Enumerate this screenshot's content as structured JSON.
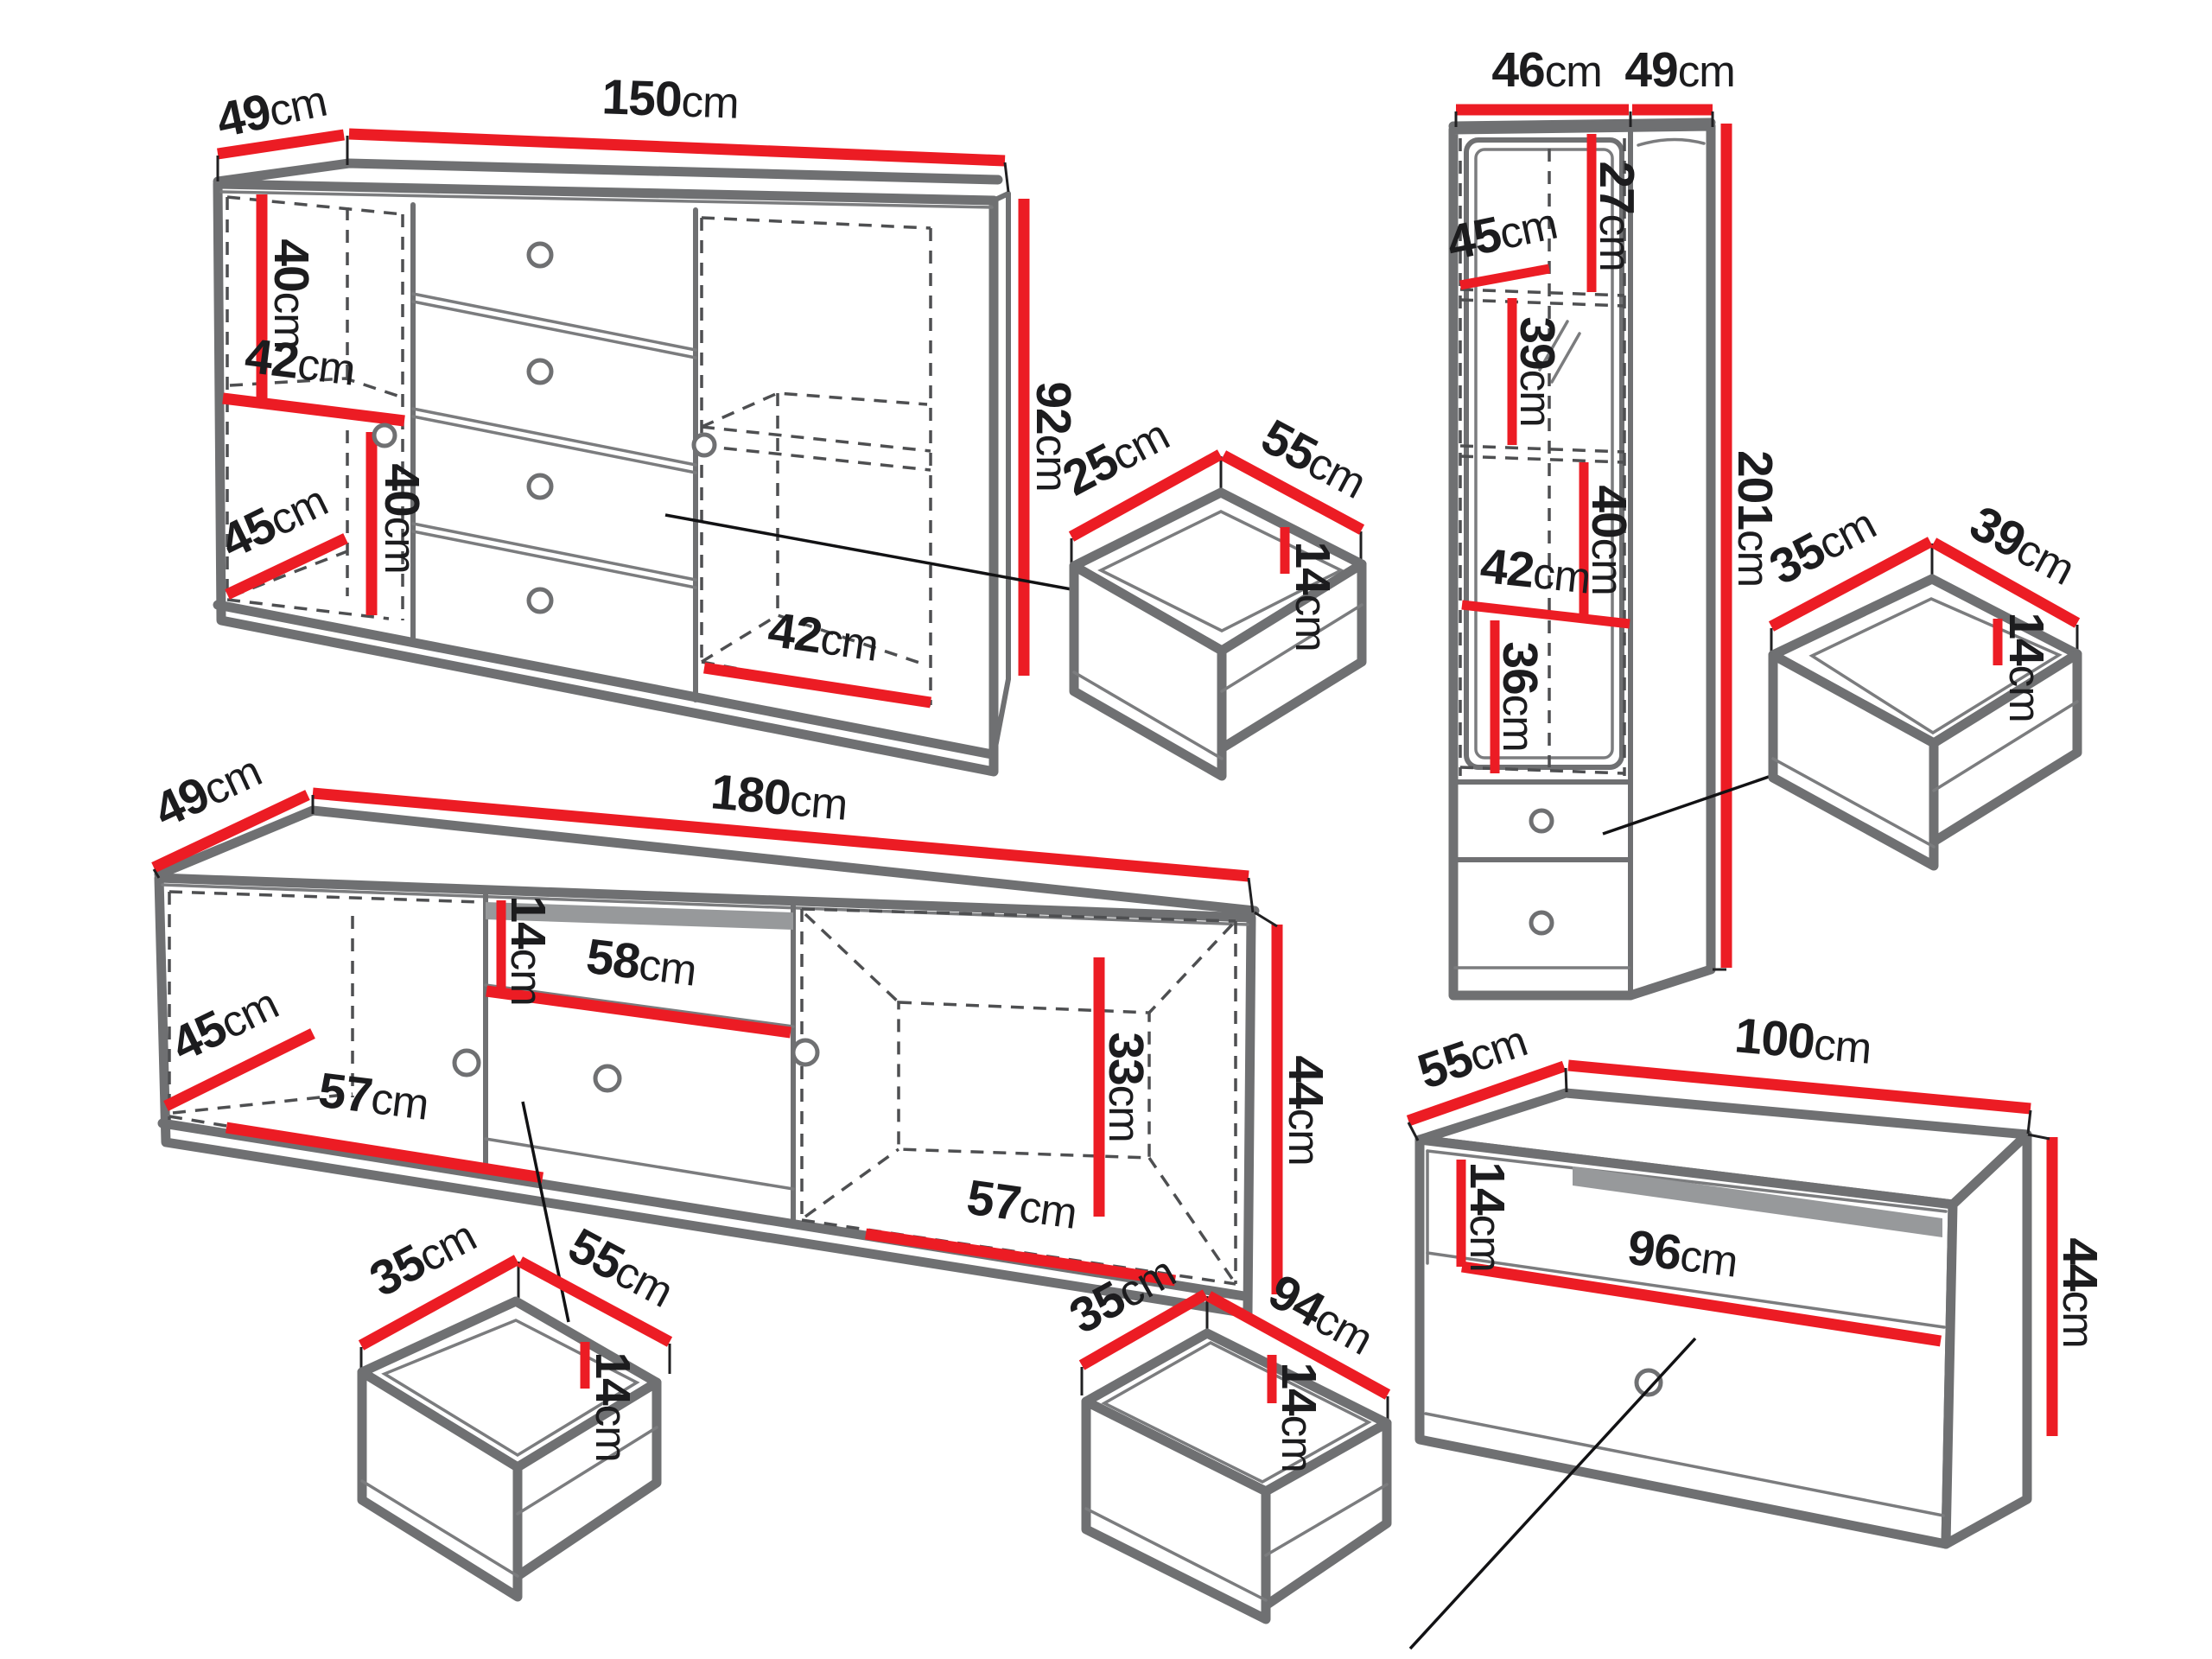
{
  "colors": {
    "dimension_red": "#ec1c24",
    "outline_gray": "#6f7072",
    "text_black": "#1c1c1e"
  },
  "sideboard": {
    "depth": {
      "value": "49",
      "unit": "cm"
    },
    "width": {
      "value": "150",
      "unit": "cm"
    },
    "height": {
      "value": "92",
      "unit": "cm"
    },
    "upper_section_height": {
      "value": "40",
      "unit": "cm"
    },
    "shelf_width": {
      "value": "42",
      "unit": "cm"
    },
    "lower_section_height": {
      "value": "40",
      "unit": "cm"
    },
    "interior_depth": {
      "value": "45",
      "unit": "cm"
    },
    "right_compartment_width": {
      "value": "42",
      "unit": "cm"
    }
  },
  "sideboard_drawer": {
    "depth": {
      "value": "25",
      "unit": "cm"
    },
    "width": {
      "value": "55",
      "unit": "cm"
    },
    "height": {
      "value": "14",
      "unit": "cm"
    }
  },
  "tall_cabinet": {
    "front_width": {
      "value": "46",
      "unit": "cm"
    },
    "side_depth": {
      "value": "49",
      "unit": "cm"
    },
    "height": {
      "value": "201",
      "unit": "cm"
    },
    "top_section_height": {
      "value": "27",
      "unit": "cm"
    },
    "interior_depth": {
      "value": "45",
      "unit": "cm"
    },
    "middle_section_height": {
      "value": "39",
      "unit": "cm"
    },
    "lower_section_height": {
      "value": "40",
      "unit": "cm"
    },
    "shelf_width": {
      "value": "42",
      "unit": "cm"
    },
    "bottom_section_height": {
      "value": "36",
      "unit": "cm"
    }
  },
  "tall_cabinet_drawer": {
    "depth": {
      "value": "35",
      "unit": "cm"
    },
    "width": {
      "value": "39",
      "unit": "cm"
    },
    "height": {
      "value": "14",
      "unit": "cm"
    }
  },
  "tv_stand": {
    "depth": {
      "value": "49",
      "unit": "cm"
    },
    "width": {
      "value": "180",
      "unit": "cm"
    },
    "height": {
      "value": "44",
      "unit": "cm"
    },
    "interior_depth": {
      "value": "45",
      "unit": "cm"
    },
    "left_compartment_width": {
      "value": "57",
      "unit": "cm"
    },
    "niche_height": {
      "value": "14",
      "unit": "cm"
    },
    "niche_width": {
      "value": "58",
      "unit": "cm"
    },
    "right_compartment_height": {
      "value": "33",
      "unit": "cm"
    },
    "right_compartment_width": {
      "value": "57",
      "unit": "cm"
    }
  },
  "tv_stand_drawer": {
    "depth": {
      "value": "35",
      "unit": "cm"
    },
    "width": {
      "value": "55",
      "unit": "cm"
    },
    "height": {
      "value": "14",
      "unit": "cm"
    }
  },
  "wide_drawer": {
    "depth": {
      "value": "35",
      "unit": "cm"
    },
    "width": {
      "value": "94",
      "unit": "cm"
    },
    "height": {
      "value": "14",
      "unit": "cm"
    }
  },
  "low_cabinet": {
    "depth": {
      "value": "55",
      "unit": "cm"
    },
    "width": {
      "value": "100",
      "unit": "cm"
    },
    "height": {
      "value": "44",
      "unit": "cm"
    },
    "niche_height": {
      "value": "14",
      "unit": "cm"
    },
    "niche_width": {
      "value": "96",
      "unit": "cm"
    }
  }
}
